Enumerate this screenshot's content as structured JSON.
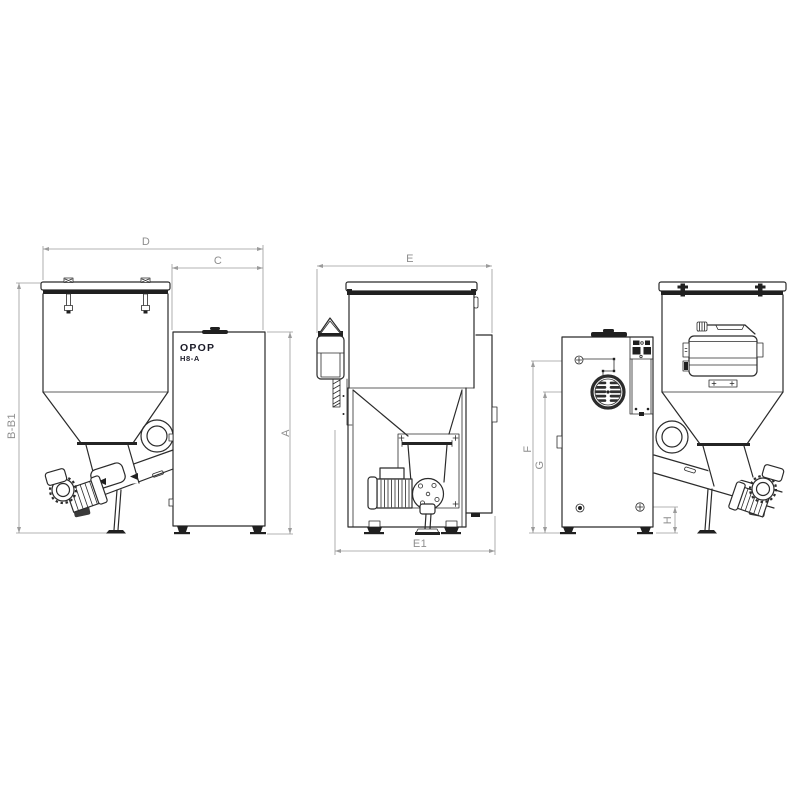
{
  "drawing": {
    "brand": "OPOP",
    "model": "H8-A",
    "labels": {
      "d": "D",
      "c": "C",
      "e": "E",
      "e1": "E1",
      "bb1": "B-B1",
      "a": "A",
      "f": "F",
      "g": "G",
      "h": "H"
    },
    "colors": {
      "line": "#2b2b2b",
      "dimension_line": "#9b9b9b",
      "dimension_label": "#8e8e8e",
      "dark_fill": "#202020",
      "background": "#ffffff"
    }
  }
}
